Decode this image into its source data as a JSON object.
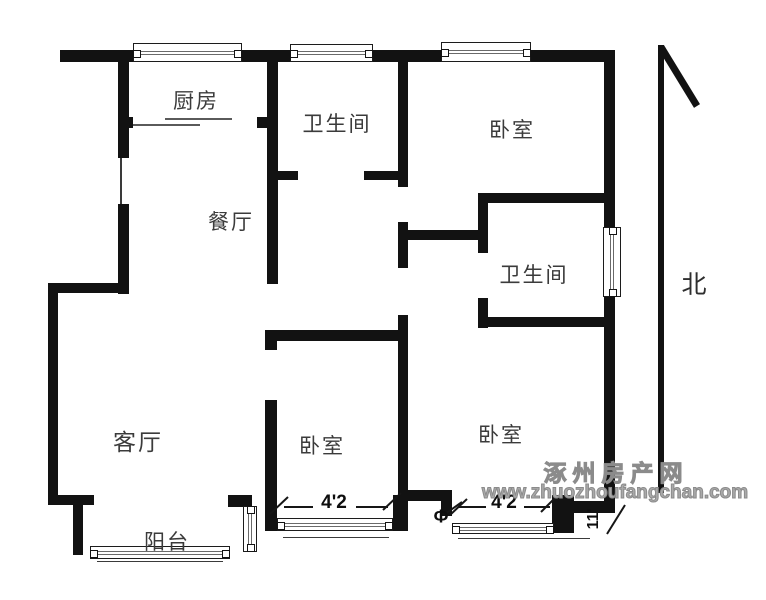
{
  "rooms": {
    "kitchen": "厨房",
    "bath_top": "卫生间",
    "bedroom_top": "卧室",
    "dining": "餐厅",
    "bath_right": "卫生间",
    "living": "客厅",
    "bedroom_mid": "卧室",
    "bedroom_right": "卧室",
    "balcony": "阳台"
  },
  "compass": {
    "north": "北"
  },
  "dimensions": {
    "mid_window": "4'2",
    "right_window": "4'2",
    "side_depth": "11'",
    "column_symbol": "Φ"
  },
  "watermark": {
    "site_name": "涿州房产网",
    "site_url": "www.zhuozhoufangchan.com"
  },
  "colors": {
    "wall": "#121212",
    "watermark": "#9a9a9a",
    "label": "#3b3b3b"
  }
}
